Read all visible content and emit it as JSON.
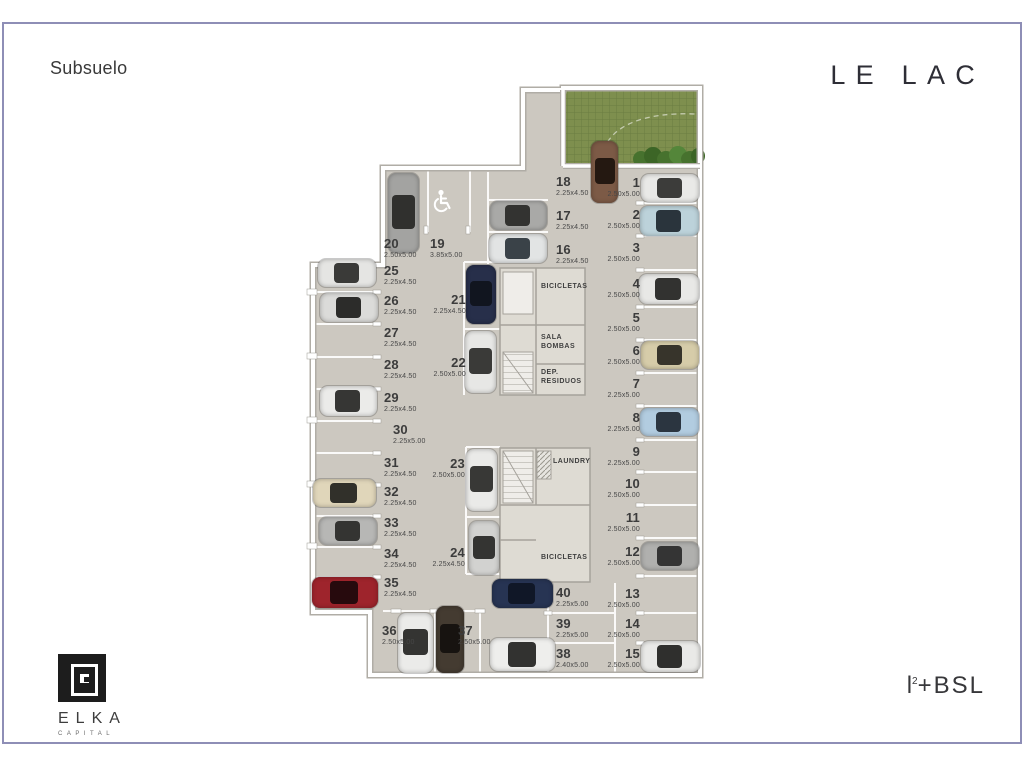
{
  "header": {
    "floor_label": "Subsuelo",
    "brand": "LE LAC"
  },
  "footer": {
    "developer_name": "ELKA",
    "developer_sub": "CAPITAL",
    "partner": {
      "base": "l",
      "sup": "2",
      "rest": "+BSL"
    }
  },
  "rooms": {
    "bicicletas_top": "BICICLETAS",
    "sala_bombas": "SALA\nBOMBAS",
    "dep_residuos": "DEP.\nRESIDUOS",
    "laundry": "LAUNDRY",
    "bicicletas_bottom": "BICICLETAS"
  },
  "icons": {
    "handicap_spot": "wheelchair-symbol",
    "stairs": "stair-hatch"
  },
  "colors": {
    "floor": "#ccc8c0",
    "wall": "#ffffff",
    "wall_edge": "#b0ada6",
    "ramp_green": "#7e8f4e",
    "hedge_green": "#47722e",
    "frame_border": "#8e8eb6",
    "text": "#3c3c3c",
    "divider": "#ffffff"
  },
  "floorplan": {
    "spots": [
      {
        "num": "18",
        "dim": "2.25x4.50",
        "x": 556,
        "y": 175,
        "anchor": "left"
      },
      {
        "num": "17",
        "dim": "2.25x4.50",
        "x": 556,
        "y": 209,
        "anchor": "left"
      },
      {
        "num": "16",
        "dim": "2.25x4.50",
        "x": 556,
        "y": 243,
        "anchor": "left"
      },
      {
        "num": "1",
        "dim": "2.50x5.00",
        "x": 640,
        "y": 176,
        "anchor": "right"
      },
      {
        "num": "2",
        "dim": "2.50x5.00",
        "x": 640,
        "y": 208,
        "anchor": "right"
      },
      {
        "num": "3",
        "dim": "2.50x5.00",
        "x": 640,
        "y": 241,
        "anchor": "right"
      },
      {
        "num": "4",
        "dim": "2.50x5.00",
        "x": 640,
        "y": 277,
        "anchor": "right"
      },
      {
        "num": "5",
        "dim": "2.50x5.00",
        "x": 640,
        "y": 311,
        "anchor": "right"
      },
      {
        "num": "6",
        "dim": "2.50x5.00",
        "x": 640,
        "y": 344,
        "anchor": "right"
      },
      {
        "num": "7",
        "dim": "2.25x5.00",
        "x": 640,
        "y": 377,
        "anchor": "right"
      },
      {
        "num": "8",
        "dim": "2.25x5.00",
        "x": 640,
        "y": 411,
        "anchor": "right"
      },
      {
        "num": "9",
        "dim": "2.25x5.00",
        "x": 640,
        "y": 445,
        "anchor": "right"
      },
      {
        "num": "10",
        "dim": "2.50x5.00",
        "x": 640,
        "y": 477,
        "anchor": "right"
      },
      {
        "num": "11",
        "dim": "2.50x5.00",
        "x": 640,
        "y": 511,
        "anchor": "right"
      },
      {
        "num": "12",
        "dim": "2.50x5.00",
        "x": 640,
        "y": 545,
        "anchor": "right"
      },
      {
        "num": "13",
        "dim": "2.50x5.00",
        "x": 640,
        "y": 587,
        "anchor": "right"
      },
      {
        "num": "14",
        "dim": "2.50x5.00",
        "x": 640,
        "y": 617,
        "anchor": "right"
      },
      {
        "num": "15",
        "dim": "2.50x5.00",
        "x": 640,
        "y": 647,
        "anchor": "right"
      },
      {
        "num": "20",
        "dim": "2.50x5.00",
        "x": 384,
        "y": 237,
        "anchor": "left"
      },
      {
        "num": "19",
        "dim": "3.85x5.00",
        "x": 430,
        "y": 237,
        "anchor": "left"
      },
      {
        "num": "25",
        "dim": "2.25x4.50",
        "x": 384,
        "y": 264,
        "anchor": "left"
      },
      {
        "num": "26",
        "dim": "2.25x4.50",
        "x": 384,
        "y": 294,
        "anchor": "left"
      },
      {
        "num": "27",
        "dim": "2.25x4.50",
        "x": 384,
        "y": 326,
        "anchor": "left"
      },
      {
        "num": "28",
        "dim": "2.25x4.50",
        "x": 384,
        "y": 358,
        "anchor": "left"
      },
      {
        "num": "29",
        "dim": "2.25x4.50",
        "x": 384,
        "y": 391,
        "anchor": "left"
      },
      {
        "num": "30",
        "dim": "2.25x5.00",
        "x": 393,
        "y": 423,
        "anchor": "left"
      },
      {
        "num": "31",
        "dim": "2.25x4.50",
        "x": 384,
        "y": 456,
        "anchor": "left"
      },
      {
        "num": "32",
        "dim": "2.25x4.50",
        "x": 384,
        "y": 485,
        "anchor": "left"
      },
      {
        "num": "33",
        "dim": "2.25x4.50",
        "x": 384,
        "y": 516,
        "anchor": "left"
      },
      {
        "num": "34",
        "dim": "2.25x4.50",
        "x": 384,
        "y": 547,
        "anchor": "left"
      },
      {
        "num": "35",
        "dim": "2.25x4.50",
        "x": 384,
        "y": 576,
        "anchor": "left"
      },
      {
        "num": "21",
        "dim": "2.25x4.50",
        "x": 466,
        "y": 293,
        "anchor": "right"
      },
      {
        "num": "22",
        "dim": "2.50x5.00",
        "x": 466,
        "y": 356,
        "anchor": "right"
      },
      {
        "num": "23",
        "dim": "2.50x5.00",
        "x": 465,
        "y": 457,
        "anchor": "right"
      },
      {
        "num": "24",
        "dim": "2.25x4.50",
        "x": 465,
        "y": 546,
        "anchor": "right"
      },
      {
        "num": "40",
        "dim": "2.25x5.00",
        "x": 556,
        "y": 586,
        "anchor": "left"
      },
      {
        "num": "39",
        "dim": "2.25x5.00",
        "x": 556,
        "y": 617,
        "anchor": "left"
      },
      {
        "num": "38",
        "dim": "2.40x5.00",
        "x": 556,
        "y": 647,
        "anchor": "left"
      },
      {
        "num": "36",
        "dim": "2.50x5.00",
        "x": 382,
        "y": 624,
        "anchor": "left"
      },
      {
        "num": "37",
        "dim": "2.50x5.00",
        "x": 458,
        "y": 624,
        "anchor": "left"
      }
    ],
    "cars": [
      {
        "spot": "20",
        "x": 388,
        "y": 173,
        "w": 31,
        "h": 80,
        "o": "v",
        "body": "#a3a3a1",
        "glass": "#30302e"
      },
      {
        "spot": "ramp",
        "x": 591,
        "y": 141,
        "w": 27,
        "h": 62,
        "o": "v",
        "body": "#7c5a46",
        "glass": "#241811"
      },
      {
        "spot": "17",
        "x": 490,
        "y": 201,
        "w": 57,
        "h": 29,
        "o": "h",
        "body": "#a9a9a7",
        "glass": "#333331"
      },
      {
        "spot": "16",
        "x": 489,
        "y": 234,
        "w": 58,
        "h": 29,
        "o": "h",
        "body": "#e2e4e4",
        "glass": "#3a4248"
      },
      {
        "spot": "1",
        "x": 641,
        "y": 174,
        "w": 58,
        "h": 28,
        "o": "h",
        "body": "#e9e9e7",
        "glass": "#3c3c3a"
      },
      {
        "spot": "2",
        "x": 640,
        "y": 206,
        "w": 59,
        "h": 30,
        "o": "h",
        "body": "#bcd2da",
        "glass": "#2a343c"
      },
      {
        "spot": "4",
        "x": 639,
        "y": 274,
        "w": 60,
        "h": 30,
        "o": "h",
        "body": "#e8e8e6",
        "glass": "#323230"
      },
      {
        "spot": "6",
        "x": 641,
        "y": 341,
        "w": 58,
        "h": 28,
        "o": "h",
        "body": "#d6cca9",
        "glass": "#37342b"
      },
      {
        "spot": "8",
        "x": 640,
        "y": 408,
        "w": 59,
        "h": 28,
        "o": "h",
        "body": "#b2cce0",
        "glass": "#2b3540"
      },
      {
        "spot": "12",
        "x": 641,
        "y": 542,
        "w": 58,
        "h": 28,
        "o": "h",
        "body": "#b0b0ae",
        "glass": "#343434"
      },
      {
        "spot": "15",
        "x": 641,
        "y": 641,
        "w": 59,
        "h": 31,
        "o": "h",
        "body": "#e9e9e7",
        "glass": "#2f2f2d"
      },
      {
        "spot": "21",
        "x": 466,
        "y": 265,
        "w": 30,
        "h": 59,
        "o": "v",
        "body": "#272f4a",
        "glass": "#11151f"
      },
      {
        "spot": "22",
        "x": 465,
        "y": 331,
        "w": 31,
        "h": 62,
        "o": "v",
        "body": "#e7e7e5",
        "glass": "#3a3a38"
      },
      {
        "spot": "23",
        "x": 466,
        "y": 449,
        "w": 31,
        "h": 62,
        "o": "v",
        "body": "#eaeae8",
        "glass": "#383836"
      },
      {
        "spot": "24",
        "x": 469,
        "y": 521,
        "w": 30,
        "h": 54,
        "o": "v",
        "body": "#d2d2d0",
        "glass": "#343432"
      },
      {
        "spot": "25",
        "x": 318,
        "y": 259,
        "w": 58,
        "h": 28,
        "o": "h",
        "body": "#e5e5e3",
        "glass": "#3a3a38"
      },
      {
        "spot": "26",
        "x": 320,
        "y": 293,
        "w": 58,
        "h": 29,
        "o": "h",
        "body": "#dbdbd9",
        "glass": "#2c2c2a"
      },
      {
        "spot": "29",
        "x": 320,
        "y": 386,
        "w": 57,
        "h": 30,
        "o": "h",
        "body": "#ebebe9",
        "glass": "#363634"
      },
      {
        "spot": "32",
        "x": 313,
        "y": 479,
        "w": 63,
        "h": 28,
        "o": "h",
        "body": "#e0d6ba",
        "glass": "#31302a"
      },
      {
        "spot": "33",
        "x": 319,
        "y": 517,
        "w": 58,
        "h": 28,
        "o": "h",
        "body": "#b7b7b5",
        "glass": "#343432"
      },
      {
        "spot": "35",
        "x": 312,
        "y": 577,
        "w": 66,
        "h": 31,
        "o": "h",
        "body": "#9e242c",
        "glass": "#270a0d"
      },
      {
        "spot": "36",
        "x": 398,
        "y": 613,
        "w": 35,
        "h": 60,
        "o": "v",
        "body": "#ebebe9",
        "glass": "#343432"
      },
      {
        "spot": "37",
        "x": 436,
        "y": 606,
        "w": 28,
        "h": 67,
        "o": "v",
        "body": "#443b31",
        "glass": "#171310"
      },
      {
        "spot": "40",
        "x": 492,
        "y": 579,
        "w": 61,
        "h": 29,
        "o": "h",
        "body": "#273453",
        "glass": "#101727"
      },
      {
        "spot": "38",
        "x": 490,
        "y": 638,
        "w": 65,
        "h": 33,
        "o": "h",
        "body": "#eeeeec",
        "glass": "#323230"
      }
    ]
  }
}
